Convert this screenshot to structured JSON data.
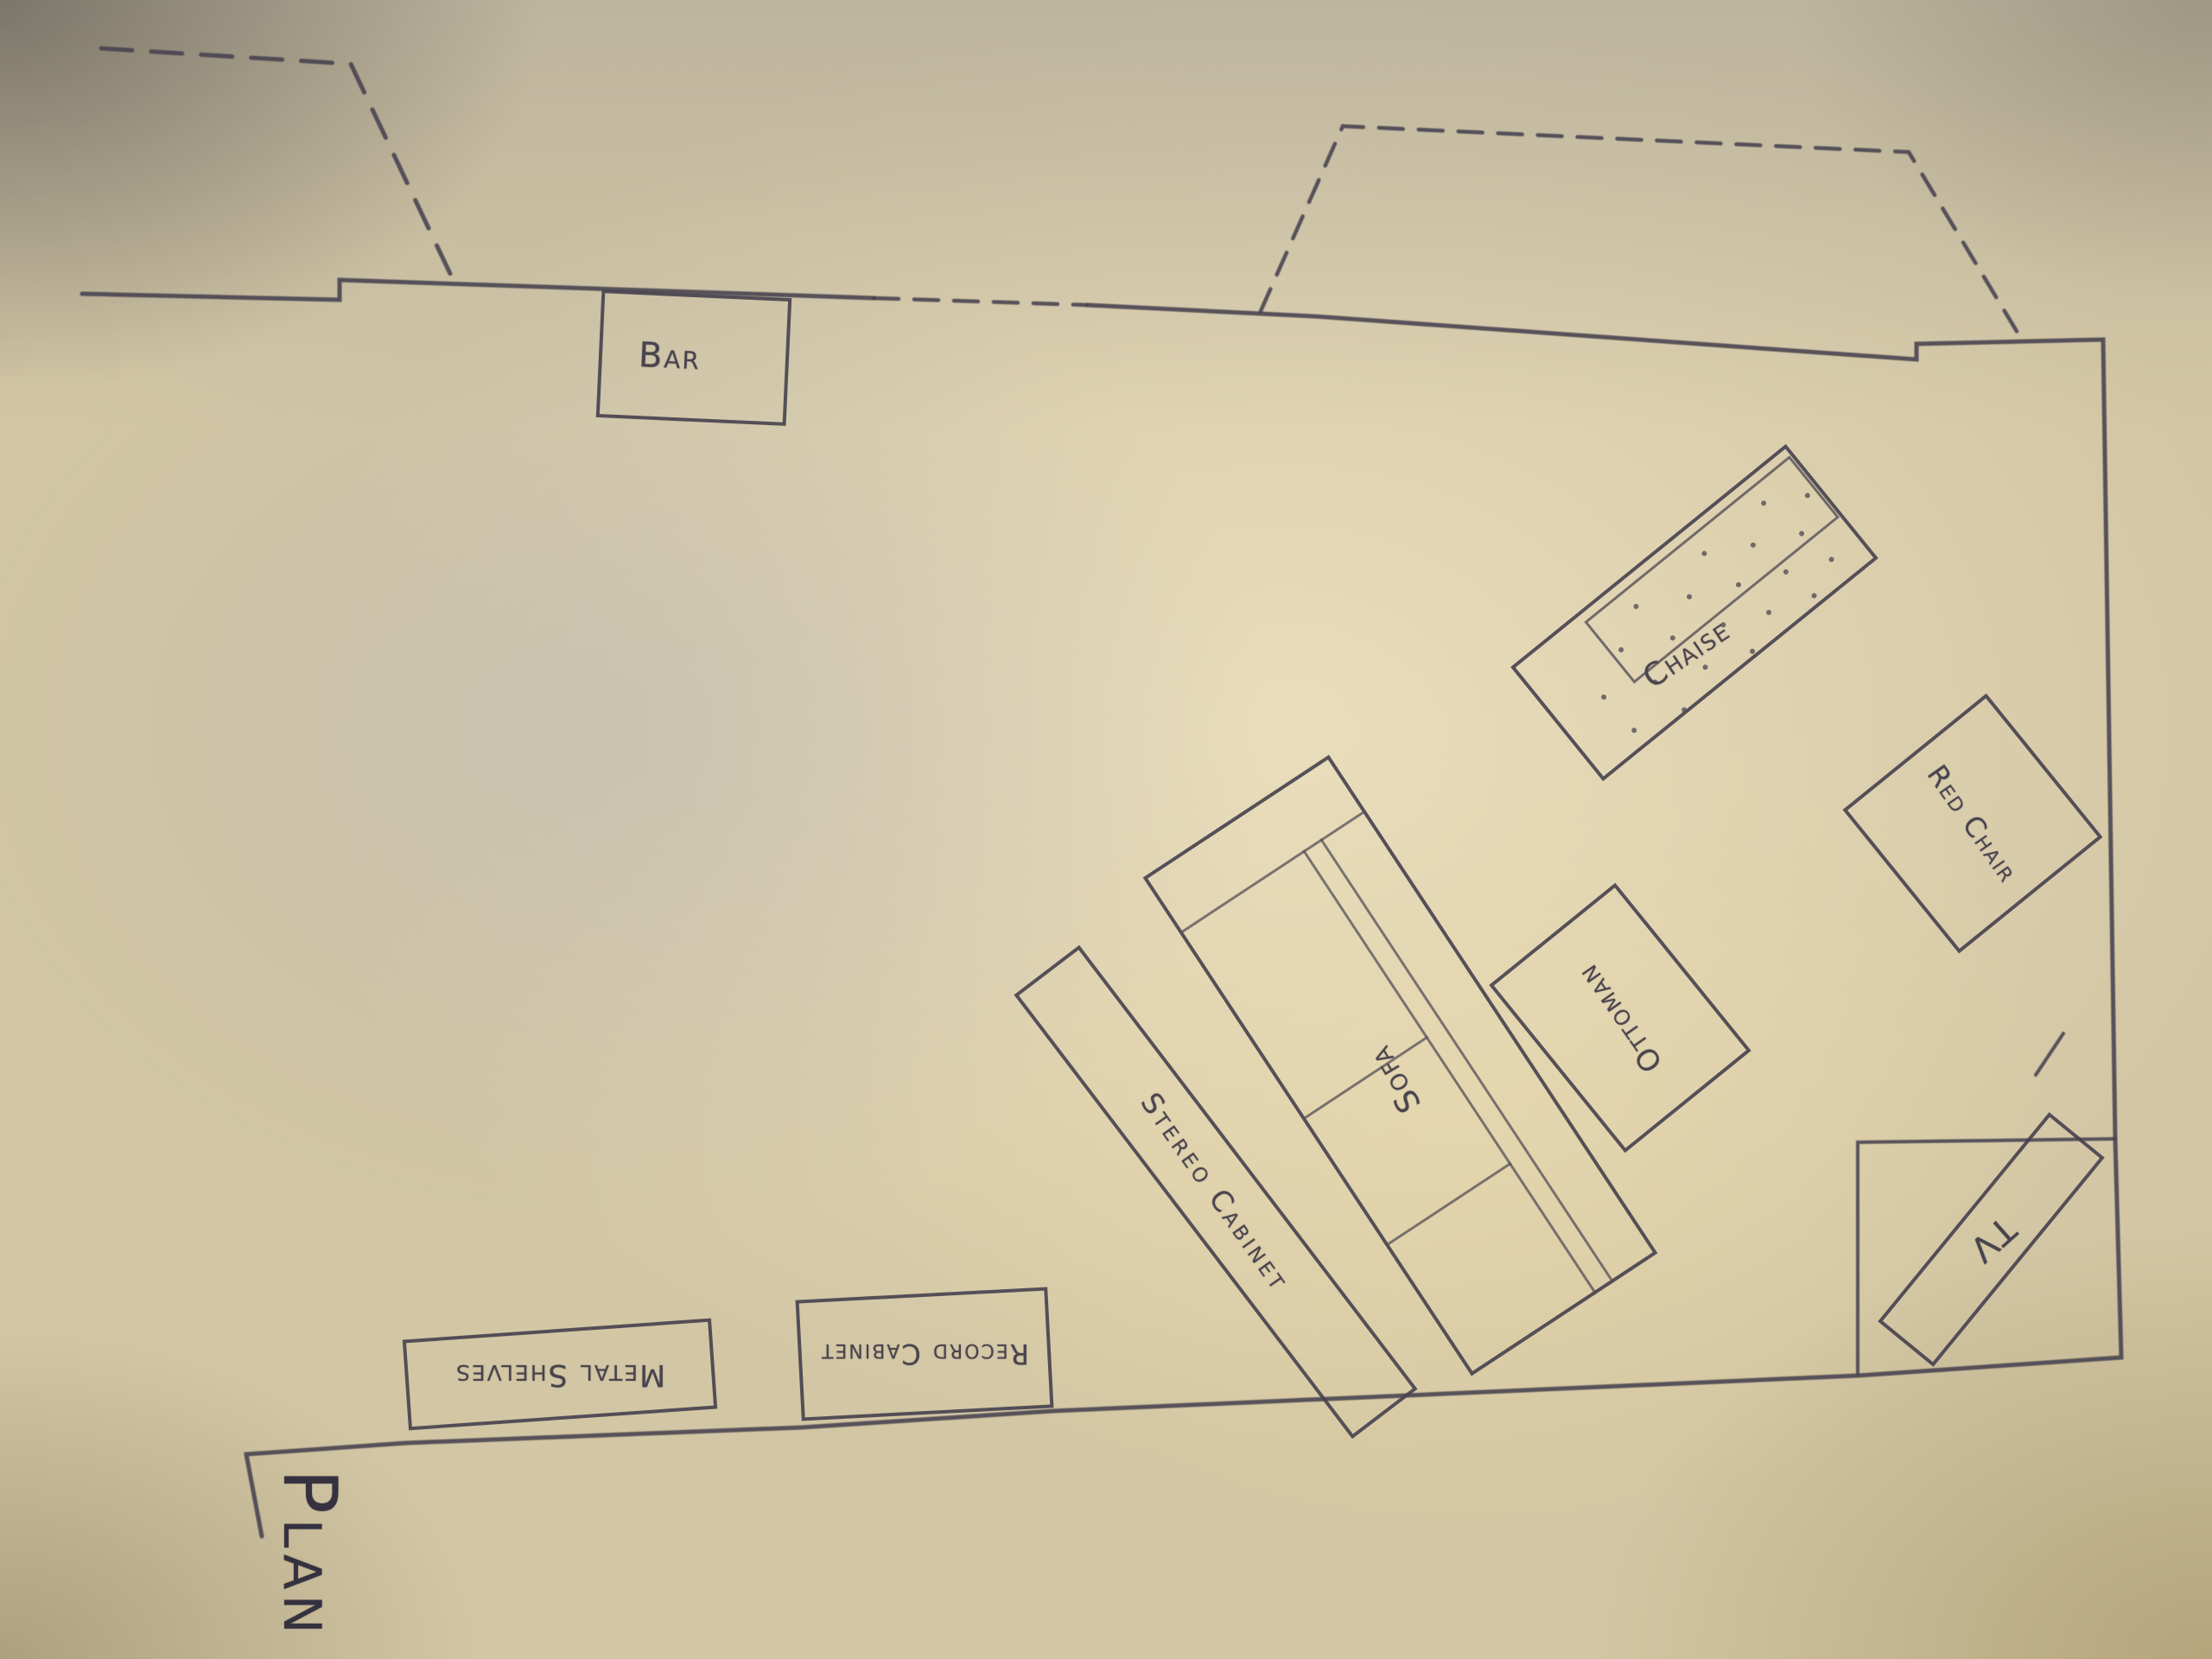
{
  "title": "Plan C",
  "furniture": {
    "bar": "Bar",
    "chaise": "Chaise",
    "red_chair": "Red Chair",
    "ottoman": "Ottoman",
    "sofa": "Sofa",
    "stereo_cabinet": "Stereo Cabinet",
    "tv": "TV",
    "record_cabinet": "Record Cabinet",
    "metal_shelves": "Metal Shelves"
  },
  "colors": {
    "ink": "#46414e",
    "paper_center": "#e9ddbc",
    "paper_base": "#d2c6a4"
  }
}
